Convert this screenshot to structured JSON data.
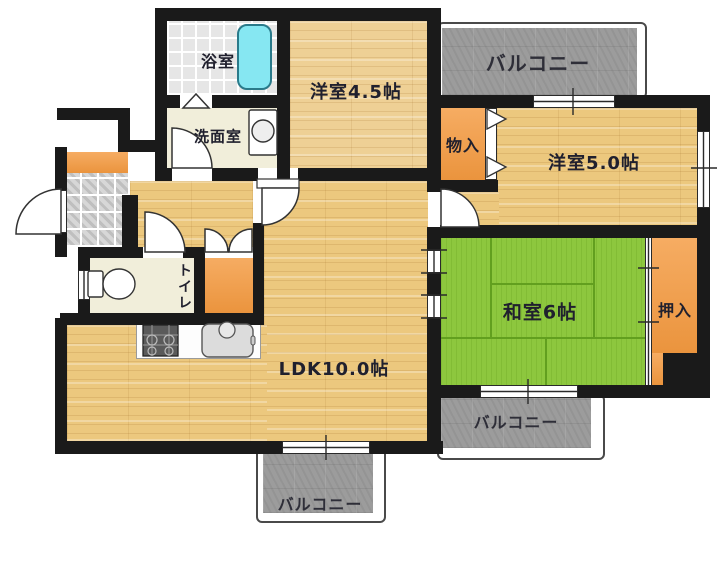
{
  "plan": {
    "title": "Japanese apartment floor plan",
    "labels": {
      "bath": "浴室",
      "washroom": "洗面室",
      "western_room_45": "洋室4.5帖",
      "balcony_top": "バルコニー",
      "storage": "物入",
      "western_room_50": "洋室5.0帖",
      "closet": "押入",
      "japanese_room_6": "和室6帖",
      "toilet": "トイレ",
      "ldk": "LDK10.0帖",
      "balcony_side": "バルコニー",
      "balcony_bottom": "バルコニー"
    },
    "colors": {
      "wall": "#1a1a1a",
      "wood_floor": "#ecc87e",
      "tatami_green": "#8dc73e",
      "closet_orange": "#f49a40",
      "balcony_gray": "#9c9c9c",
      "bathtub_cyan": "#86e7f2",
      "entry_tile_gray": "#d7d7d7",
      "service_floor": "#f1eeda"
    }
  }
}
